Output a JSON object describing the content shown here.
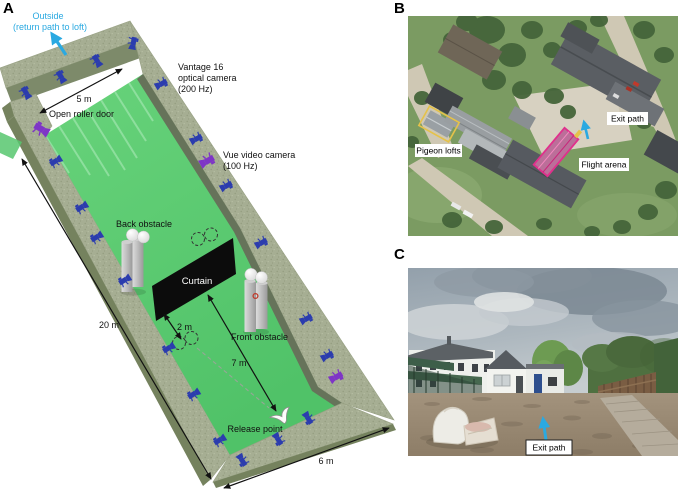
{
  "colors": {
    "cyan": "#2aa9e1",
    "camera_blue": "#2b3cae",
    "camera_purple": "#7e35c6",
    "floor_green": "#57c76e",
    "floor_streak": "#93e0a2",
    "wall_top": "#a6ae93",
    "wall_face": "#75825e",
    "wall_face_light": "#7d8a6a",
    "wall_face_dark": "#66735a",
    "curtain_black": "#0c0c0c",
    "obstacle_gray": "#b9bcbd",
    "arena_magenta": "#e0308c",
    "lofts_yellow": "#e5c24a",
    "sat_grass": "#7b9b62",
    "sat_tree": "#45653a",
    "sat_road": "#cfc8b4",
    "sat_roof": "#565a60",
    "sky_gray": "#a8b2ba",
    "ground_tan": "#9b8a74"
  },
  "panels": {
    "a": {
      "letter": "A",
      "outside_line1": "Outside",
      "outside_line2": "(return path to loft)",
      "vantage_line1": "Vantage 16",
      "vantage_line2": "optical camera",
      "vantage_line3": "(200 Hz)",
      "vue_line1": "Vue video camera",
      "vue_line2": "(100 Hz)",
      "open_roller_door": "Open roller door",
      "back_obstacle": "Back obstacle",
      "front_obstacle": "Front obstacle",
      "curtain": "Curtain",
      "release_point": "Release point",
      "dim_door": "5 m",
      "dim_length": "20 m",
      "dim_curtain_gap": "2 m",
      "dim_release": "7 m",
      "dim_width": "6 m"
    },
    "b": {
      "letter": "B",
      "pigeon_lofts": "Pigeon lofts",
      "exit_path": "Exit path",
      "flight_arena": "Flight arena"
    },
    "c": {
      "letter": "C",
      "exit_path": "Exit path"
    }
  }
}
